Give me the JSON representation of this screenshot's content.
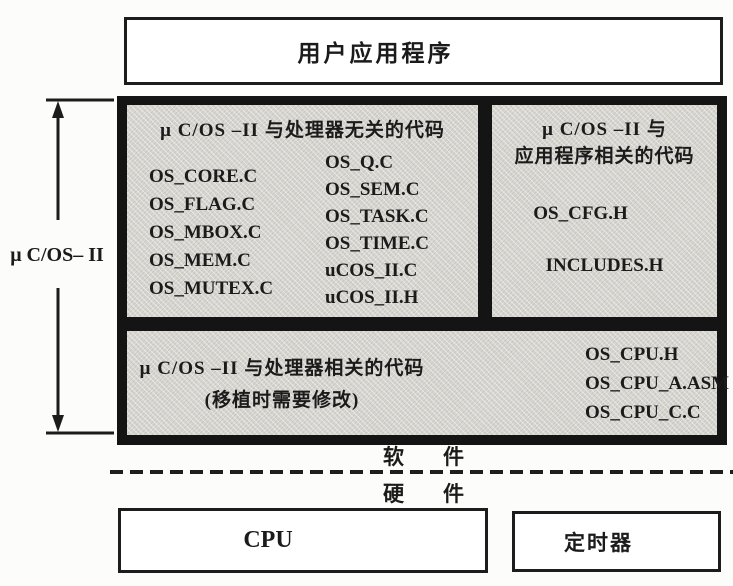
{
  "top_box": {
    "label": "用户应用程序"
  },
  "side": {
    "os_label": "μ C/OS– II"
  },
  "main": {
    "independent": {
      "title": "μ C/OS –II 与处理器无关的代码",
      "files_col1": [
        "OS_CORE.C",
        "OS_FLAG.C",
        "OS_MBOX.C",
        "OS_MEM.C",
        "OS_MUTEX.C"
      ],
      "files_col2": [
        "OS_Q.C",
        "OS_SEM.C",
        "OS_TASK.C",
        "OS_TIME.C",
        "uCOS_II.C",
        "uCOS_II.H"
      ]
    },
    "app_related": {
      "title_line1": "μ C/OS –II 与",
      "title_line2": "应用程序相关的代码",
      "files": [
        "OS_CFG.H",
        "INCLUDES.H"
      ]
    },
    "cpu_related": {
      "title_line1": "μ C/OS –II 与处理器相关的代码",
      "title_line2": "(移植时需要修改)",
      "files": [
        "OS_CPU.H",
        "OS_CPU_A.ASM",
        "OS_CPU_C.C"
      ]
    }
  },
  "divider": {
    "software_char1": "软",
    "software_char2": "件",
    "hardware_char1": "硬",
    "hardware_char2": "件"
  },
  "hardware": {
    "cpu_label": "CPU",
    "timer_label": "定时器"
  },
  "colors": {
    "panel_gray": "#d8d6d0",
    "frame_black": "#141414",
    "border": "#1c1c1c",
    "background": "#fcfcfa"
  }
}
